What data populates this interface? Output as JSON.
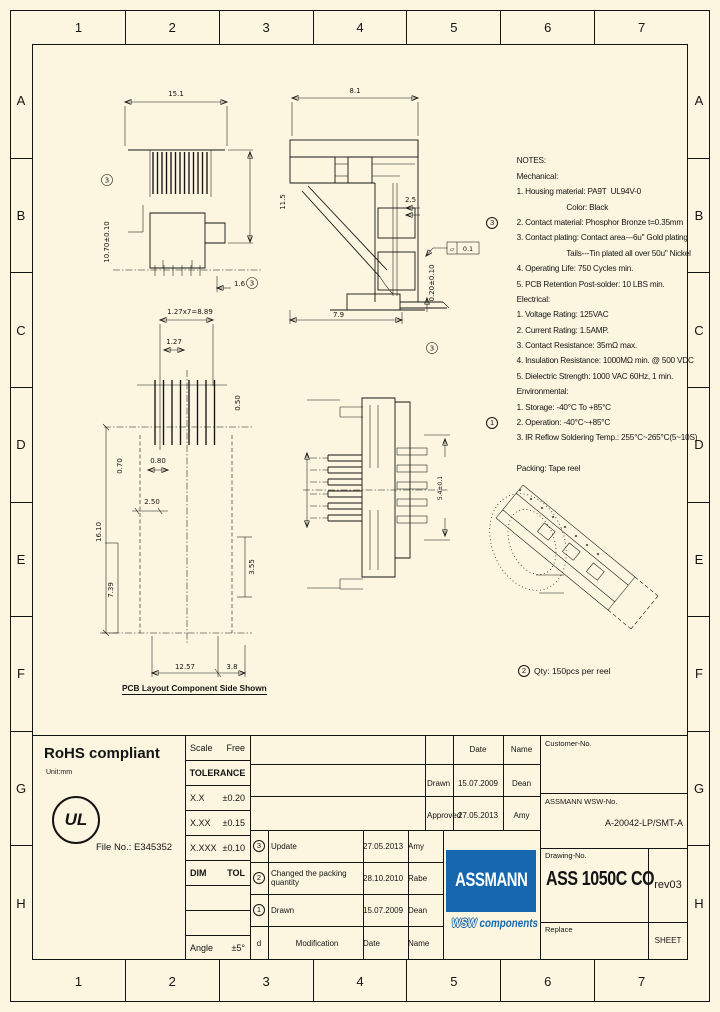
{
  "sheet": {
    "columns": [
      "1",
      "2",
      "3",
      "4",
      "5",
      "6",
      "7"
    ],
    "rows": [
      "A",
      "B",
      "C",
      "D",
      "E",
      "F",
      "G",
      "H"
    ]
  },
  "colors": {
    "background": "#fcf6e0",
    "line": "#141414",
    "logo_blue": "#1667ae"
  },
  "notes": {
    "lines": [
      {
        "t": "NOTES:"
      },
      {
        "t": "Mechanical:"
      },
      {
        "t": "1. Housing material: PA9T  UL94V-0"
      },
      {
        "t": "                        Color: Black"
      },
      {
        "t": "2. Contact material: Phosphor Bronze t=0.35mm"
      },
      {
        "b": "3",
        "t": "3. Contact plating: Contact area---6u\" Gold plating"
      },
      {
        "t": "                        Tails---Tin plated all over 50u\" Nickel"
      },
      {
        "t": "4. Operating Life: 750 Cycles min."
      },
      {
        "t": "5. PCB Retention Post-solder: 10 LBS min."
      },
      {
        "t": "Electrical:"
      },
      {
        "t": "1. Voltage Rating: 125VAC"
      },
      {
        "t": "2. Current Rating: 1.5AMP."
      },
      {
        "t": "3. Contact Resistance: 35mΩ max."
      },
      {
        "t": "4. Insulation Resistance: 1000MΩ min. @ 500 VDC"
      },
      {
        "t": "5. Dielectric Strength: 1000 VAC 60Hz, 1 min."
      },
      {
        "t": "Environmental:"
      },
      {
        "t": "1. Storage: -40°C To +85°C"
      },
      {
        "t": "2. Operation: -40°C~+85°C"
      },
      {
        "b": "1",
        "t": "3. IR Reflow Soldering Temp.: 255°C~265°C(5~10S)"
      },
      {
        "t": ""
      },
      {
        "t": "Packing: Tape reel"
      }
    ]
  },
  "drawings": {
    "front_view": {
      "dim_width": "15.1",
      "dim_height": "10.70±0.10",
      "dim_height_balloon": "3",
      "dim_foot": "1.6",
      "dim_foot_balloon": "3"
    },
    "section_view": {
      "dim_width": "8.1",
      "dim_height": "11.5",
      "dim_tab": "2.5",
      "dim_bottom": "7.9",
      "dim_standoff": "0.20±0.10",
      "standoff_balloon": "3",
      "flatness_symbol": "▱",
      "flatness": "0.1"
    },
    "pcb_layout": {
      "dim_pitch_total": "1.27x7=8.89",
      "dim_pitch": "1.27",
      "dim_pad": "0.80",
      "dim_hole": "0.50",
      "dim_a": "0.70",
      "dim_b": "2.50",
      "dim_c": "16.10",
      "dim_d": "7.39",
      "dim_e": "3.55",
      "dim_span": "12.57",
      "dim_f": "3.8",
      "caption": "PCB Layout Component Side Shown"
    },
    "bottom_view": {
      "dim_side": "5.4±0.1"
    },
    "packing": {
      "balloon": "2",
      "text": "Qty: 150pcs per reel"
    }
  },
  "compliance": {
    "rohs": "RoHS compliant",
    "unit": "Unit:mm",
    "ul_mark": "UL",
    "file_no": "File No.: E345352"
  },
  "titleblock": {
    "scale_label": "Scale",
    "scale_value": "Free",
    "tolerance_label": "TOLERANCE",
    "tol_rows": [
      {
        "dim": "X.X",
        "tol": "±0.20"
      },
      {
        "dim": "X.XX",
        "tol": "±0.15"
      },
      {
        "dim": "X.XXX",
        "tol": "±0.10"
      }
    ],
    "dim_label": "DIM",
    "tol_label": "TOL",
    "angle_label": "Angle",
    "angle_value": "±5°",
    "rev_rows": [
      {
        "no": "3",
        "mod": "Update",
        "date": "27.05.2013",
        "name": "Amy"
      },
      {
        "no": "2",
        "mod": "Changed the packing quantity",
        "date": "28.10.2010",
        "name": "Rabe"
      },
      {
        "no": "1",
        "mod": "Drawn",
        "date": "15.07.2009",
        "name": "Dean"
      }
    ],
    "rev_header": {
      "d": "d",
      "modification": "Modification",
      "date": "Date",
      "name": "Name"
    },
    "sign_header": {
      "date": "Date",
      "name": "Name"
    },
    "sign_rows": [
      {
        "role": "Drawn",
        "date": "15.07.2009",
        "name": "Dean"
      },
      {
        "role": "Approved",
        "date": "27.05.2013",
        "name": "Amy"
      }
    ],
    "customer_label": "Customer-No.",
    "assmann_label": "ASSMANN WSW-No.",
    "assmann_no": "A-20042-LP/SMT-A",
    "drawing_label": "Drawing-No.",
    "drawing_no": "ASS 1050C CO",
    "revision": "rev03",
    "replace_label": "Replace",
    "sheet_label": "SHEET",
    "logo_line1": "ASSMANN",
    "logo_wsw": "WSW",
    "logo_components": "components"
  }
}
